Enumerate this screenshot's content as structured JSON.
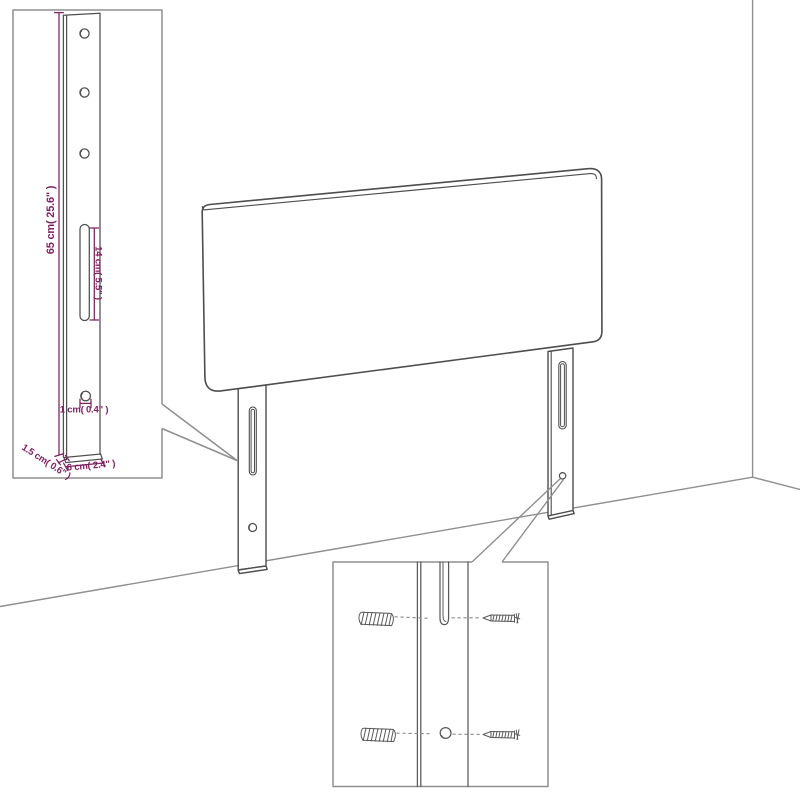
{
  "diagram": {
    "subject": "headboard with two wall-mount legs in room corner",
    "insets": {
      "leg_detail": {
        "dim_height": "65 cm( 25.6\" )",
        "dim_slot": "14 cm( 5.5\" )",
        "dim_hole": "1 cm( 0.4\" )",
        "dim_thickness": "1.5 cm( 0.6\" )",
        "dim_width": "6 cm( 2.4\" )"
      },
      "hardware_detail": {
        "parts": [
          "wall-plug",
          "screw"
        ]
      }
    },
    "colors": {
      "dimension_text": "#7d2161",
      "product_line": "#4d4d4d",
      "background_line": "#8f8f8f",
      "background": "#ffffff"
    }
  }
}
